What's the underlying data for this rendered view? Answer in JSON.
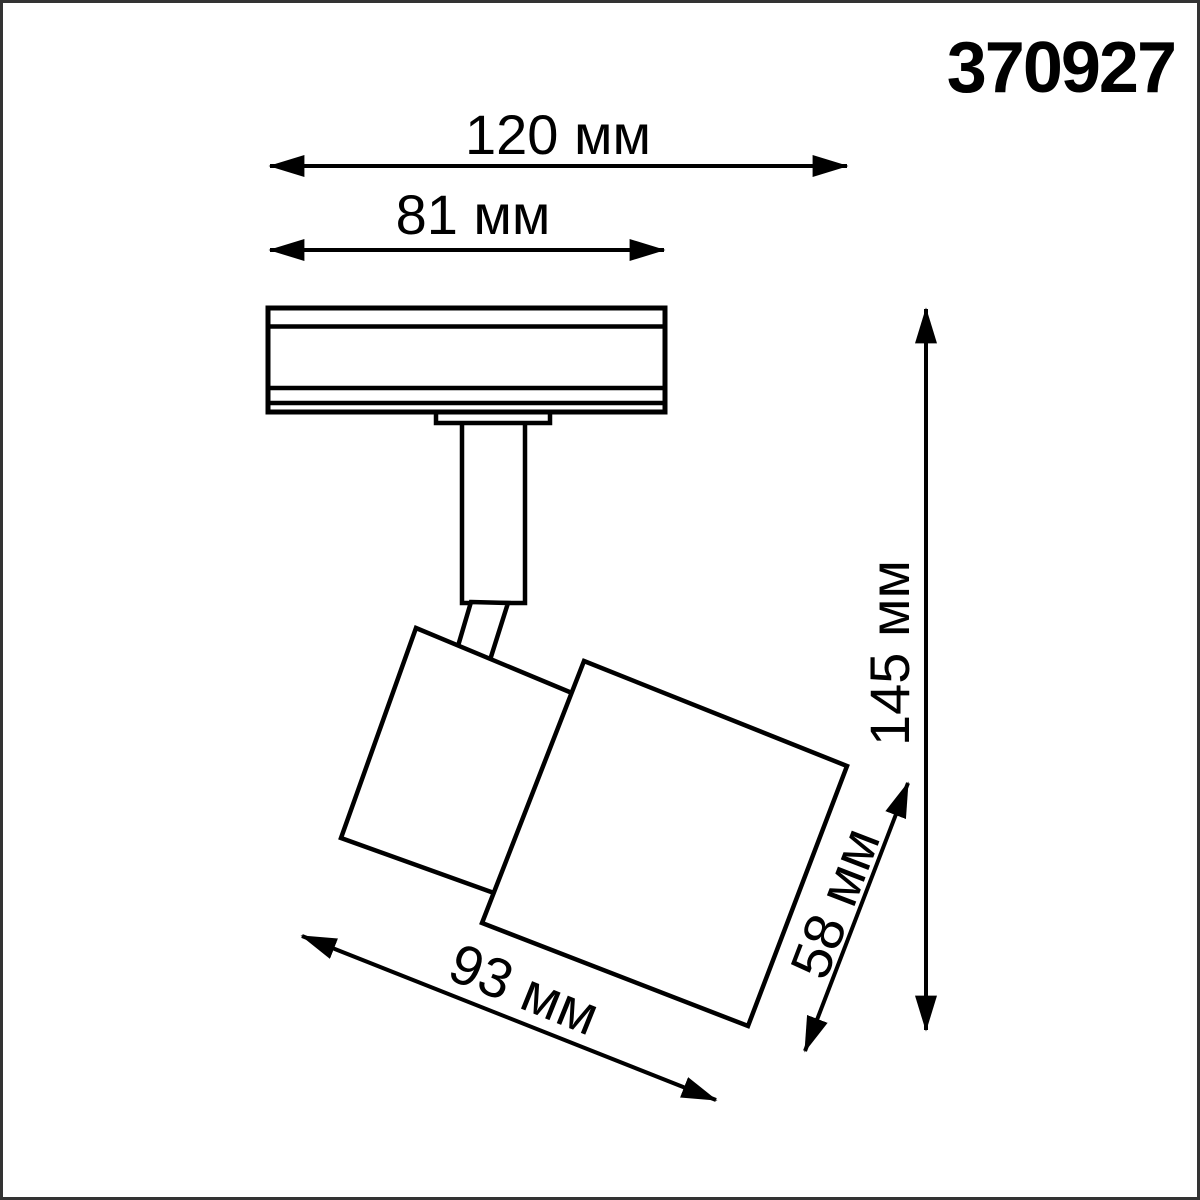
{
  "product_code": "370927",
  "drawing": {
    "type": "technical-dimension-drawing",
    "subject": "track-mounted spotlight, side view",
    "colors": {
      "line": "#000000",
      "background": "#ffffff",
      "frame": "#333333"
    }
  },
  "dimensions": {
    "track_width": {
      "value": 120,
      "unit": "мм",
      "label": "120 мм"
    },
    "adapter_width": {
      "value": 81,
      "unit": "мм",
      "label": "81 мм"
    },
    "total_height": {
      "value": 145,
      "unit": "мм",
      "label": "145 мм"
    },
    "head_length": {
      "value": 93,
      "unit": "мм",
      "label": "93 мм"
    },
    "head_diameter": {
      "value": 58,
      "unit": "мм",
      "label": "58 мм"
    }
  }
}
